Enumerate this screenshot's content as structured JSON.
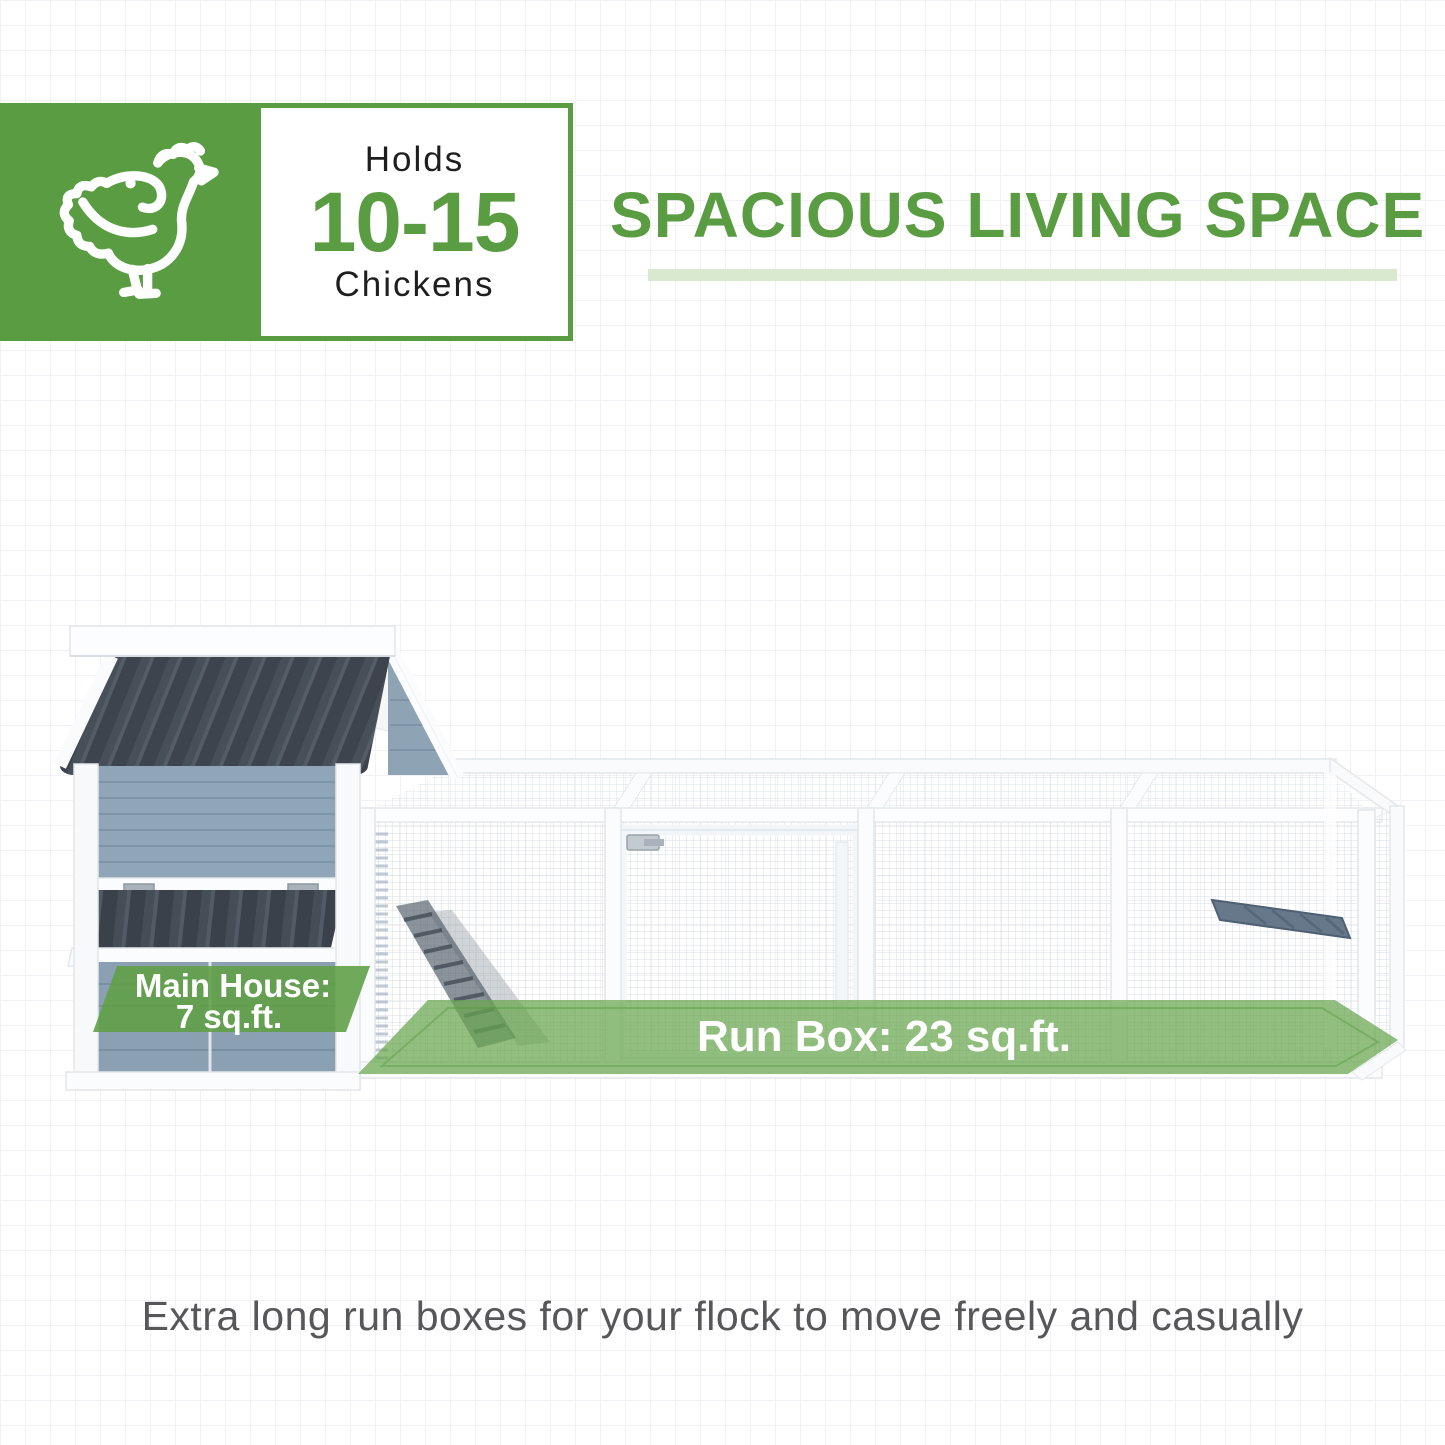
{
  "theme": {
    "green": "#5a9c42",
    "light_green_bar": "#d9e9cf",
    "overlay_green": "#68a64e",
    "roof_dark": "#3d444d",
    "house_blue_gray": "#90a5b7",
    "mesh_gray": "#d4dbe0",
    "caption_gray": "#57575a",
    "text_dark": "#1e1e1e"
  },
  "capacity_badge": {
    "icon": "chicken-icon",
    "prefix": "Holds",
    "count": "10-15",
    "suffix": "Chickens"
  },
  "headline": {
    "title": "SPACIOUS LIVING SPACE"
  },
  "illustration": {
    "main_house_label_line1": "Main House:",
    "main_house_label_line2": "7 sq.ft.",
    "run_box_label": "Run Box: 23 sq.ft."
  },
  "caption": {
    "text": "Extra long run boxes for your flock to move freely and casually"
  }
}
